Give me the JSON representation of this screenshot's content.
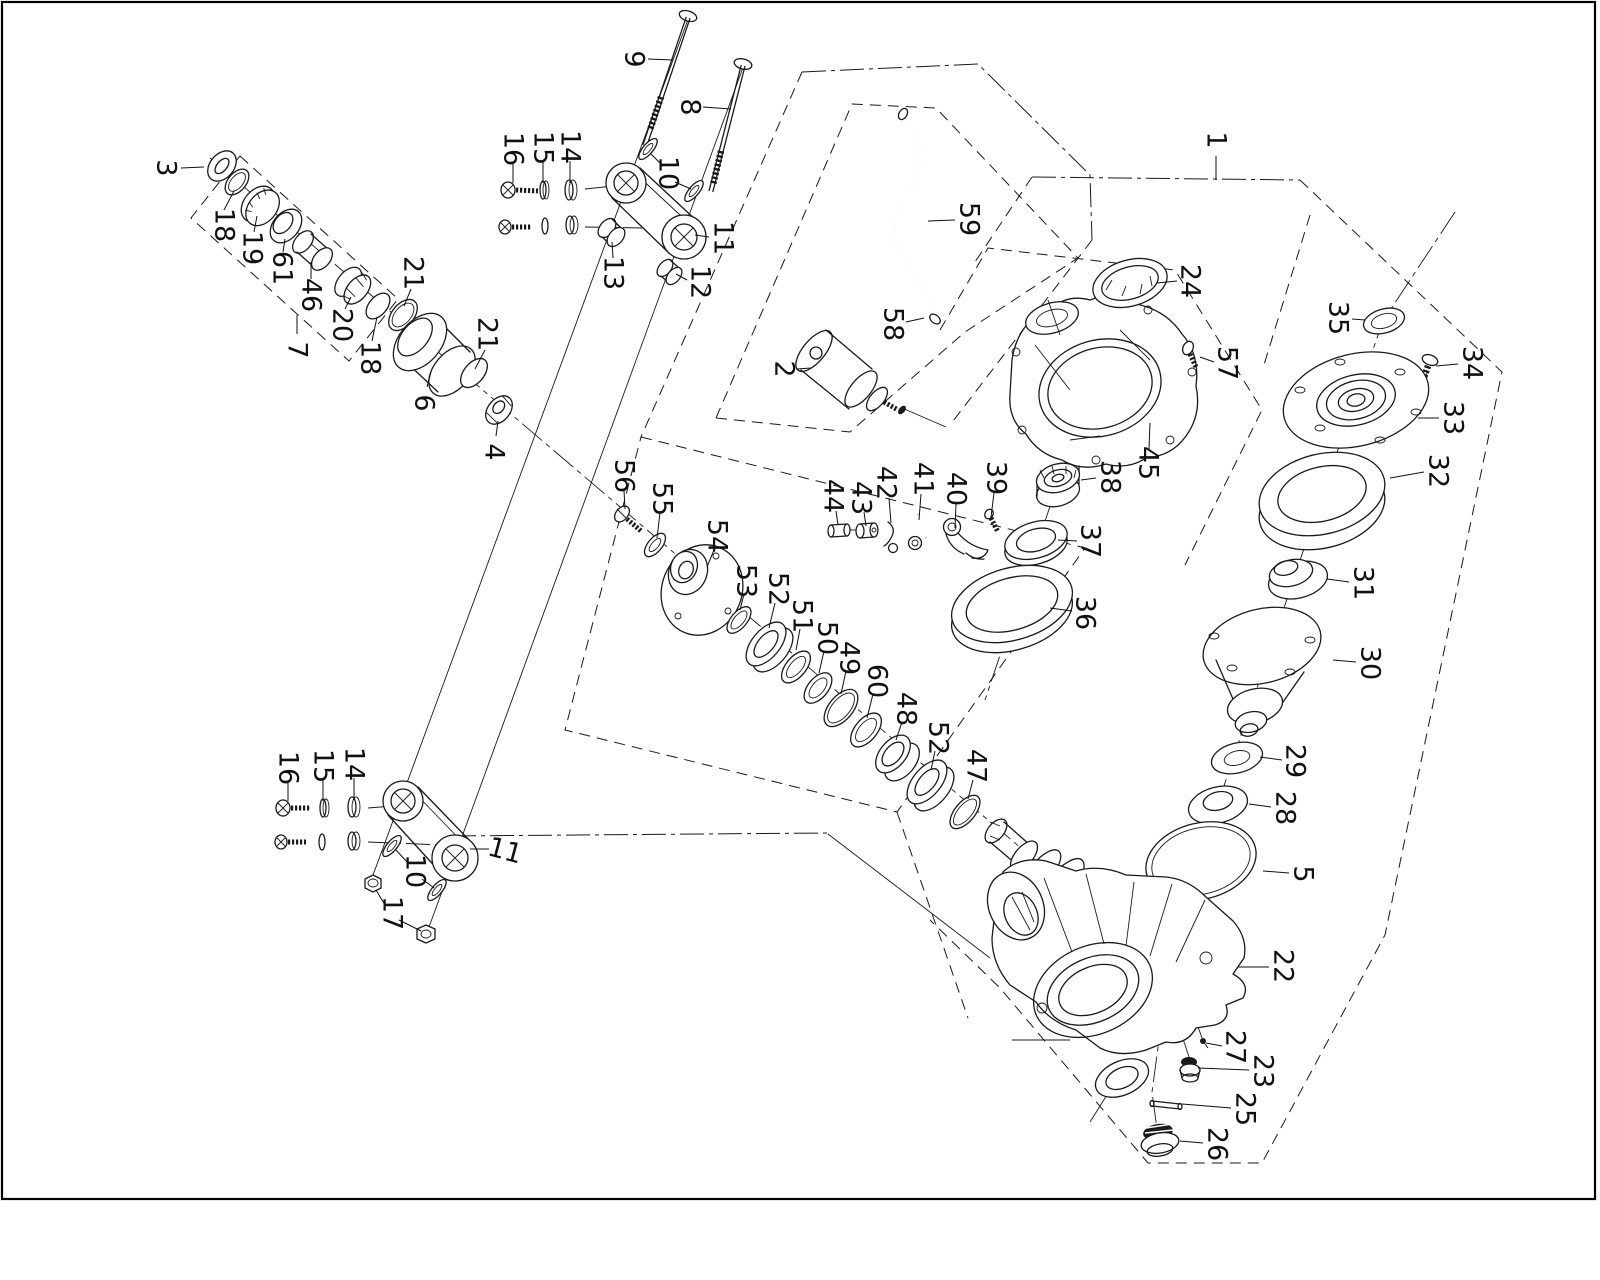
{
  "page": {
    "background": "#ffffff",
    "ink": "#1a1a1a",
    "border_color": "#000000"
  },
  "diagram": {
    "type": "exploded-parts-diagram"
  },
  "callouts": [
    {
      "n": "1",
      "x": 1216,
      "y": 140,
      "leaders": [
        [
          1216,
          156,
          1216,
          180
        ]
      ]
    },
    {
      "n": "2",
      "x": 784,
      "y": 369,
      "leaders": [
        [
          797,
          369,
          811,
          368
        ]
      ]
    },
    {
      "n": "3",
      "x": 166,
      "y": 168,
      "leaders": [
        [
          181,
          168,
          204,
          167
        ]
      ]
    },
    {
      "n": "4",
      "x": 494,
      "y": 452,
      "leaders": [
        [
          496,
          436,
          498,
          421
        ]
      ]
    },
    {
      "n": "5",
      "x": 1303,
      "y": 874,
      "leaders": [
        [
          1289,
          873,
          1263,
          871
        ]
      ]
    },
    {
      "n": "6",
      "x": 424,
      "y": 403,
      "leaders": [
        [
          427,
          387,
          431,
          372
        ]
      ]
    },
    {
      "n": "7",
      "x": 297,
      "y": 350,
      "leaders": [
        [
          297,
          334,
          297,
          315
        ]
      ]
    },
    {
      "n": "8",
      "x": 690,
      "y": 107,
      "leaders": [
        [
          703,
          107,
          731,
          109
        ]
      ]
    },
    {
      "n": "9",
      "x": 634,
      "y": 59,
      "leaders": [
        [
          648,
          59,
          673,
          60
        ]
      ]
    },
    {
      "n": "10",
      "x": 668,
      "y": 173,
      "leaders": [
        [
          661,
          164,
          650,
          153
        ],
        [
          675,
          182,
          691,
          189
        ]
      ]
    },
    {
      "n": "11",
      "x": 723,
      "y": 238,
      "leaders": [
        [
          709,
          237,
          695,
          235
        ]
      ]
    },
    {
      "n": "12",
      "x": 700,
      "y": 282,
      "leaders": [
        [
          687,
          280,
          676,
          274
        ]
      ]
    },
    {
      "n": "13",
      "x": 613,
      "y": 273,
      "leaders": [
        [
          613,
          258,
          612,
          242
        ]
      ]
    },
    {
      "n": "14",
      "x": 570,
      "y": 147,
      "leaders": [
        [
          570,
          161,
          570,
          183
        ]
      ]
    },
    {
      "n": "15",
      "x": 543,
      "y": 148,
      "leaders": [
        [
          543,
          162,
          543,
          183
        ]
      ]
    },
    {
      "n": "16",
      "x": 513,
      "y": 149,
      "leaders": [
        [
          513,
          163,
          513,
          183
        ]
      ]
    },
    {
      "n": "16",
      "x": 288,
      "y": 768,
      "leaders": [
        [
          288,
          782,
          288,
          801
        ]
      ]
    },
    {
      "n": "15",
      "x": 323,
      "y": 766,
      "leaders": [
        [
          323,
          780,
          323,
          801
        ]
      ]
    },
    {
      "n": "14",
      "x": 354,
      "y": 764,
      "leaders": [
        [
          354,
          778,
          354,
          800
        ]
      ]
    },
    {
      "n": "10",
      "x": 415,
      "y": 871,
      "leaders": [
        [
          408,
          863,
          396,
          850
        ],
        [
          422,
          879,
          434,
          888
        ]
      ]
    },
    {
      "n": "11",
      "x": 505,
      "y": 851,
      "r": 15,
      "leaders": [
        [
          470,
          849,
          489,
          849
        ]
      ]
    },
    {
      "n": "17",
      "x": 392,
      "y": 913,
      "leaders": [
        [
          385,
          905,
          376,
          890
        ],
        [
          399,
          920,
          421,
          931
        ]
      ]
    },
    {
      "n": "18",
      "x": 224,
      "y": 225,
      "leaders": [
        [
          224,
          210,
          234,
          191
        ]
      ]
    },
    {
      "n": "19",
      "x": 252,
      "y": 248,
      "leaders": [
        [
          254,
          232,
          257,
          216
        ]
      ]
    },
    {
      "n": "61",
      "x": 282,
      "y": 268,
      "leaders": [
        [
          283,
          252,
          285,
          239
        ]
      ]
    },
    {
      "n": "46",
      "x": 311,
      "y": 295,
      "leaders": [
        [
          311,
          279,
          311,
          262
        ]
      ]
    },
    {
      "n": "20",
      "x": 342,
      "y": 325,
      "leaders": [
        [
          345,
          309,
          351,
          297
        ]
      ]
    },
    {
      "n": "18",
      "x": 370,
      "y": 358,
      "leaders": [
        [
          372,
          341,
          377,
          317
        ]
      ]
    },
    {
      "n": "21",
      "x": 413,
      "y": 273,
      "leaders": [
        [
          411,
          289,
          404,
          306
        ]
      ]
    },
    {
      "n": "21",
      "x": 487,
      "y": 334,
      "leaders": [
        [
          485,
          350,
          475,
          369
        ]
      ]
    },
    {
      "n": "22",
      "x": 1283,
      "y": 966,
      "leaders": [
        [
          1269,
          967,
          1238,
          967
        ]
      ]
    },
    {
      "n": "23",
      "x": 1263,
      "y": 1071,
      "leaders": [
        [
          1249,
          1070,
          1198,
          1068
        ]
      ]
    },
    {
      "n": "24",
      "x": 1190,
      "y": 281,
      "leaders": [
        [
          1177,
          281,
          1157,
          283
        ]
      ]
    },
    {
      "n": "25",
      "x": 1245,
      "y": 1109,
      "leaders": [
        [
          1231,
          1108,
          1182,
          1104
        ]
      ]
    },
    {
      "n": "26",
      "x": 1217,
      "y": 1144,
      "leaders": [
        [
          1203,
          1143,
          1180,
          1141
        ]
      ]
    },
    {
      "n": "27",
      "x": 1235,
      "y": 1047,
      "leaders": [
        [
          1222,
          1046,
          1206,
          1043
        ]
      ]
    },
    {
      "n": "28",
      "x": 1285,
      "y": 808,
      "leaders": [
        [
          1271,
          807,
          1249,
          804
        ]
      ]
    },
    {
      "n": "29",
      "x": 1295,
      "y": 761,
      "leaders": [
        [
          1282,
          760,
          1260,
          757
        ]
      ]
    },
    {
      "n": "30",
      "x": 1370,
      "y": 663,
      "leaders": [
        [
          1356,
          662,
          1333,
          660
        ]
      ]
    },
    {
      "n": "31",
      "x": 1363,
      "y": 583,
      "leaders": [
        [
          1349,
          582,
          1327,
          579
        ]
      ]
    },
    {
      "n": "32",
      "x": 1438,
      "y": 471,
      "leaders": [
        [
          1424,
          472,
          1390,
          478
        ]
      ]
    },
    {
      "n": "33",
      "x": 1453,
      "y": 418,
      "leaders": [
        [
          1439,
          418,
          1418,
          418
        ]
      ]
    },
    {
      "n": "34",
      "x": 1472,
      "y": 363,
      "leaders": [
        [
          1458,
          364,
          1436,
          366
        ]
      ]
    },
    {
      "n": "35",
      "x": 1338,
      "y": 318,
      "leaders": [
        [
          1352,
          319,
          1365,
          320
        ]
      ]
    },
    {
      "n": "36",
      "x": 1085,
      "y": 613,
      "leaders": [
        [
          1072,
          611,
          1050,
          608
        ]
      ]
    },
    {
      "n": "37",
      "x": 1090,
      "y": 541,
      "leaders": [
        [
          1077,
          541,
          1058,
          540
        ]
      ]
    },
    {
      "n": "38",
      "x": 1110,
      "y": 477,
      "leaders": [
        [
          1096,
          478,
          1081,
          480
        ]
      ]
    },
    {
      "n": "39",
      "x": 996,
      "y": 478,
      "leaders": [
        [
          994,
          493,
          991,
          517
        ]
      ]
    },
    {
      "n": "40",
      "x": 956,
      "y": 489,
      "leaders": [
        [
          956,
          504,
          955,
          528
        ]
      ]
    },
    {
      "n": "41",
      "x": 923,
      "y": 479,
      "leaders": [
        [
          921,
          494,
          919,
          520
        ]
      ]
    },
    {
      "n": "42",
      "x": 886,
      "y": 483,
      "leaders": [
        [
          889,
          498,
          891,
          523
        ]
      ]
    },
    {
      "n": "43",
      "x": 861,
      "y": 498,
      "leaders": [
        [
          864,
          512,
          866,
          526
        ]
      ]
    },
    {
      "n": "44",
      "x": 833,
      "y": 496,
      "leaders": [
        [
          836,
          511,
          838,
          525
        ]
      ]
    },
    {
      "n": "45",
      "x": 1148,
      "y": 463,
      "leaders": [
        [
          1149,
          449,
          1150,
          423
        ]
      ]
    },
    {
      "n": "47",
      "x": 976,
      "y": 766,
      "leaders": [
        [
          973,
          780,
          968,
          799
        ]
      ]
    },
    {
      "n": "48",
      "x": 906,
      "y": 709,
      "leaders": [
        [
          902,
          722,
          896,
          740
        ]
      ]
    },
    {
      "n": "49",
      "x": 849,
      "y": 658,
      "leaders": [
        [
          846,
          671,
          841,
          694
        ]
      ]
    },
    {
      "n": "50",
      "x": 827,
      "y": 638,
      "leaders": [
        [
          824,
          651,
          819,
          673
        ]
      ]
    },
    {
      "n": "51",
      "x": 802,
      "y": 616,
      "leaders": [
        [
          800,
          629,
          796,
          650
        ]
      ]
    },
    {
      "n": "52",
      "x": 778,
      "y": 589,
      "leaders": [
        [
          775,
          603,
          769,
          628
        ]
      ]
    },
    {
      "n": "52",
      "x": 938,
      "y": 738,
      "leaders": [
        [
          935,
          751,
          931,
          770
        ]
      ]
    },
    {
      "n": "53",
      "x": 746,
      "y": 581,
      "leaders": [
        [
          744,
          594,
          740,
          610
        ]
      ]
    },
    {
      "n": "54",
      "x": 717,
      "y": 536,
      "leaders": [
        [
          714,
          550,
          707,
          567
        ]
      ]
    },
    {
      "n": "55",
      "x": 662,
      "y": 499,
      "leaders": [
        [
          660,
          513,
          657,
          538
        ]
      ]
    },
    {
      "n": "56",
      "x": 624,
      "y": 476,
      "leaders": [
        [
          624,
          490,
          625,
          509
        ]
      ]
    },
    {
      "n": "57",
      "x": 1227,
      "y": 363,
      "leaders": [
        [
          1214,
          362,
          1200,
          357
        ]
      ]
    },
    {
      "n": "58",
      "x": 893,
      "y": 324,
      "leaders": [
        [
          906,
          322,
          924,
          318
        ]
      ]
    },
    {
      "n": "59",
      "x": 969,
      "y": 219,
      "leaders": [
        [
          955,
          220,
          928,
          221
        ]
      ]
    },
    {
      "n": "60",
      "x": 877,
      "y": 681,
      "leaders": [
        [
          873,
          694,
          867,
          718
        ]
      ]
    }
  ]
}
